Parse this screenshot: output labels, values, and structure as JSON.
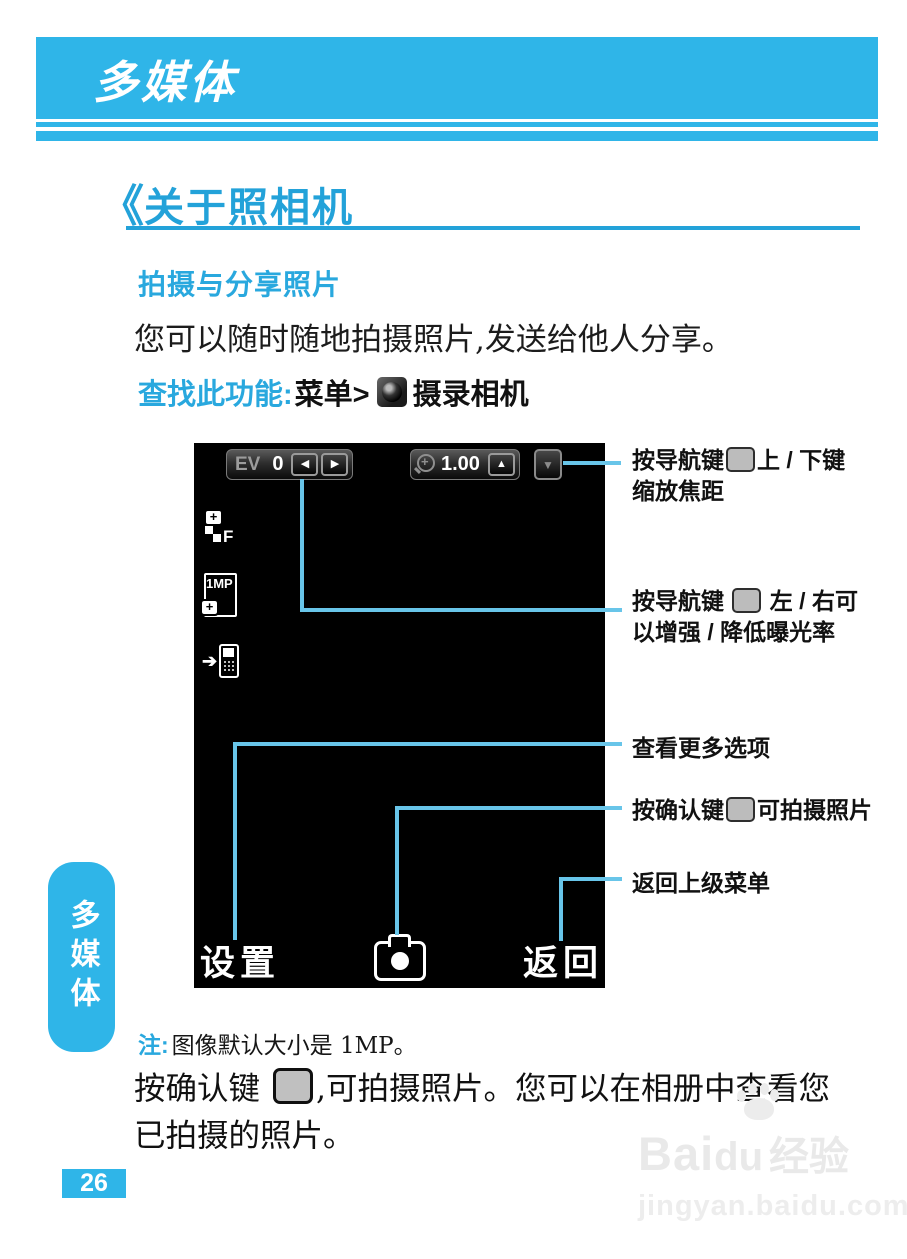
{
  "colors": {
    "brand_blue": "#2fb5e8",
    "heading_blue": "#23a2d9",
    "accent_blue": "#29a8de",
    "callout_line": "#68c5e9",
    "text_black": "#111111",
    "watermark_gray": "#e9e9e9"
  },
  "header": {
    "title": "多媒体"
  },
  "section": {
    "marker": "《",
    "title": "关于照相机"
  },
  "subsection": {
    "title": "拍摄与分享照片"
  },
  "intro": {
    "text": "您可以随时随地拍摄照片,发送给他人分享。"
  },
  "find_feature": {
    "label": "查找此功能:",
    "menu": "菜单>",
    "camera_icon": "camera-menu-icon",
    "suffix": "摄录相机"
  },
  "viewfinder": {
    "ev": {
      "label": "EV",
      "value": "0",
      "left_arrow": "◀",
      "right_arrow": "▶"
    },
    "zoom": {
      "icon": "magnifier-icon",
      "value": "1.00",
      "up_arrow": "▲",
      "down_arrow": "▼"
    },
    "side_icons": [
      {
        "icon": "flash-mode-icon",
        "label": "F"
      },
      {
        "icon": "image-size-icon",
        "label": "1MP"
      },
      {
        "icon": "storage-location-icon",
        "arrow": "➔"
      }
    ],
    "softkeys": {
      "left": "设置",
      "center_icon": "shutter-camera-icon",
      "right": "返回"
    }
  },
  "callouts": [
    {
      "pre": "按导航键",
      "key": "nav-key-icon",
      "post": "上 / 下键",
      "line2": "缩放焦距"
    },
    {
      "pre": "按导航键 ",
      "key": "nav-key-icon",
      "post": " 左 / 右可",
      "line2": "以增强 / 降低曝光率"
    },
    {
      "text": "查看更多选项"
    },
    {
      "pre": "按确认键",
      "key": "ok-key-icon",
      "post": "可拍摄照片"
    },
    {
      "text": "返回上级菜单"
    }
  ],
  "note": {
    "label": "注:",
    "text": "图像默认大小是 1MP。"
  },
  "outro": {
    "line1_pre": "按确认键 ",
    "key": "ok-key-icon",
    "line1_post": ",可拍摄照片。您可以在相册中查看您",
    "line2": "已拍摄的照片。"
  },
  "sidebar_tab": {
    "label": "多媒体"
  },
  "page_number": "26",
  "watermark": {
    "brand_pre": "Bai",
    "brand_post": "du",
    "brand_cn": "经验",
    "url": "jingyan.baidu.com"
  }
}
